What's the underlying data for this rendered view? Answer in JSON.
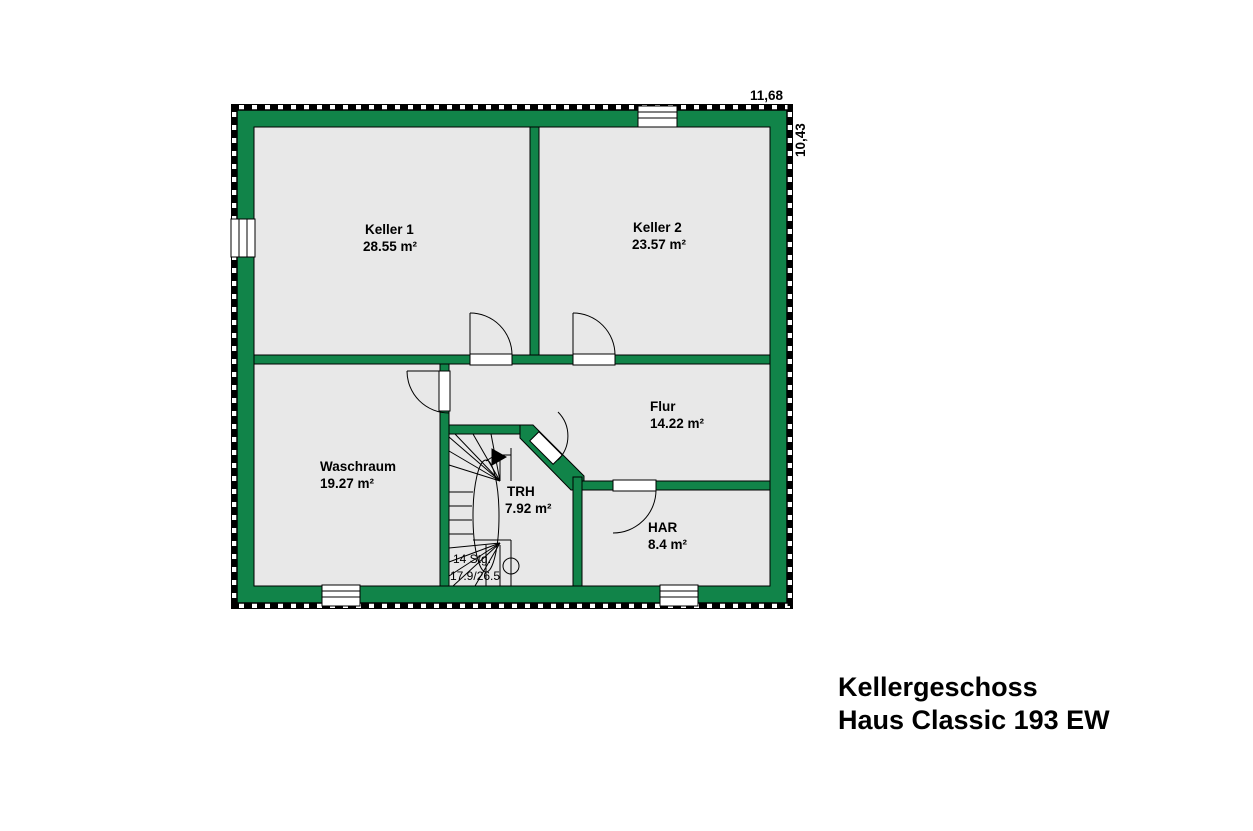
{
  "title": {
    "line1": "Kellergeschoss",
    "line2": "Haus Classic 193 EW"
  },
  "dimensions": {
    "overall_width_m": "11,68",
    "overall_height_m": "10,43"
  },
  "rooms": [
    {
      "name": "Keller 1",
      "area": "28.55 m²"
    },
    {
      "name": "Keller 2",
      "area": "23.57 m²"
    },
    {
      "name": "Flur",
      "area": "14.22 m²"
    },
    {
      "name": "Waschraum",
      "area": "19.27 m²"
    },
    {
      "name": "TRH",
      "area": "7.92 m²"
    },
    {
      "name": "HAR",
      "area": "8.4 m²"
    }
  ],
  "stairs": {
    "note_line1": "14 Stg.",
    "note_line2": "17.9/26.5"
  },
  "colors": {
    "wall": "#118449",
    "room_fill": "#e8e8e8",
    "outline": "#000000",
    "background": "#ffffff"
  }
}
